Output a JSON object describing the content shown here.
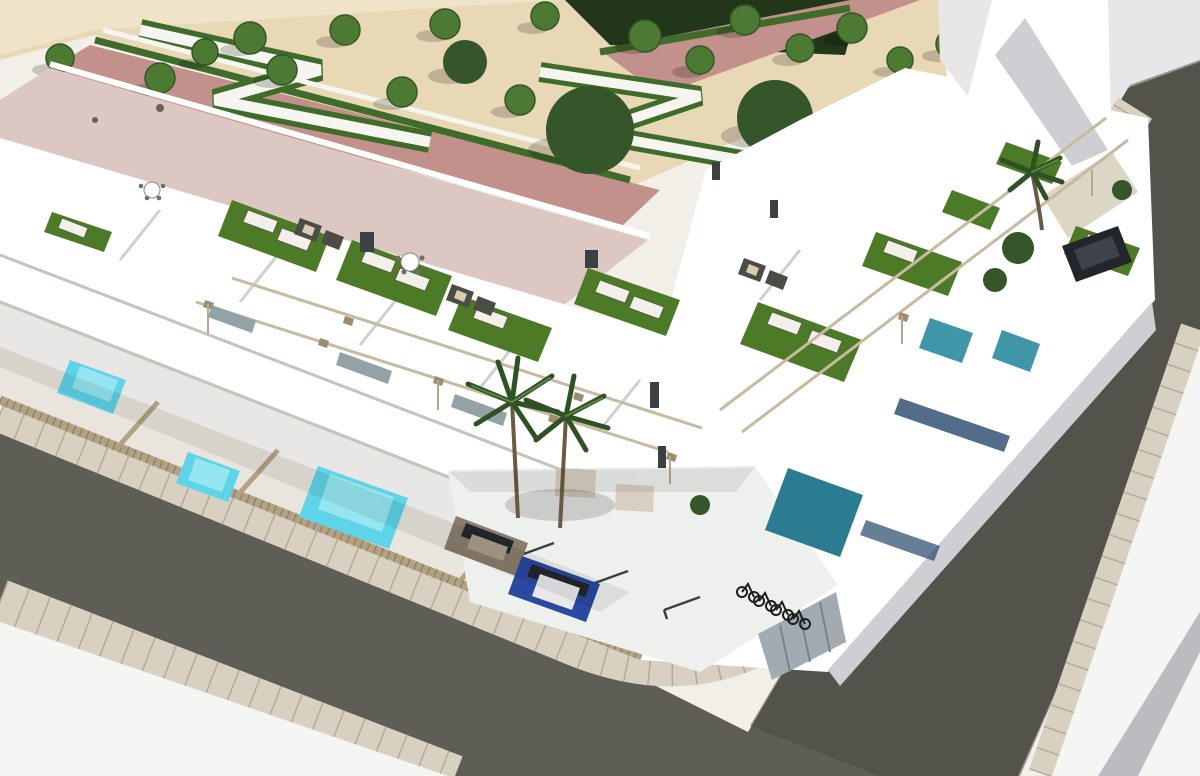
{
  "scene": {
    "type": "architectural-3d-render",
    "description": "Aerial 3D rendering of a modern white residential complex on a street corner: rows of townhouses with rooftop terraces (artificial grass, sun loungers, pergolas), private turquoise pools behind slatted fences, an interior parking court with cars and a bicycle shelter, palm trees, and a landscaped plaza with tree rows, zig-zag hedges and pink paved promenades.",
    "objects": {
      "park_trees": 22,
      "palm_trees": 3,
      "rooftop_terraces": 10,
      "sun_loungers": 12,
      "swimming_pools": 6,
      "cars": 3,
      "bicycles": 4,
      "streets": 2,
      "bicycle_shelter": 1,
      "pergola_rails": 4
    }
  },
  "palette": {
    "canvas_bg": "#f2efe9",
    "sky_gray": "#e7e7e9",
    "sand": "#e8d8b6",
    "sand_light": "#efe3c8",
    "pink_path": "#c2918b",
    "roof_pink": "#dcc7c2",
    "hedge_green": "#3f6b2b",
    "hedge_dark": "#22371a",
    "path_white": "#f7f5ef",
    "tree_green": "#4d7a33",
    "tree_dark": "#35552a",
    "shadow_black": "#000000",
    "white_wall": "#ffffff",
    "wall_shade": "#cfcfd3",
    "wall_shade_light": "#e8e7e5",
    "wall_shade_warm": "#d9d2c6",
    "yard_floor": "#e9e5dc",
    "court_floor": "#eef0ee",
    "terrace_grass": "#4c7a27",
    "lounger_white": "#f3f0e9",
    "lounger_edge": "#55524c",
    "sofa_dark": "#4d4b46",
    "cushion_beige": "#d8cdb2",
    "pergola_tan": "#c8ba9f",
    "post_tan": "#9c8d72",
    "fence_tan": "#b2a183",
    "fence_slat": "#8b7c62",
    "pool_turquoise": "#5fd3e8",
    "pool_light": "#b4f0f6",
    "pool_teal_mid": "#3f96a8",
    "pool_teal_dark": "#2b7c90",
    "pool_navy": "#27476b",
    "asphalt": "#5e5d56",
    "asphalt_dark": "#4a4944",
    "paver": "#d8d1c1",
    "paver_line": "#b4ab97",
    "lot_white": "#f5f5f4",
    "stripe_gray": "#8e8a96",
    "car_brown": "#8a7d6d",
    "car_brown_roof": "#ab9e8c",
    "car_blue": "#2a49a0",
    "car_roof_white": "#e9e9eb",
    "glass_dark": "#23262b",
    "car_dark": "#22252a",
    "car_dark_glass": "#3d434a",
    "bike_dark": "#1d1d1d",
    "shed_gray": "#a3abb2",
    "shed_line": "#7b828a",
    "window_dark": "#3b4042",
    "glass_teal": "#93a2a4",
    "beige_door": "#d8cfc0",
    "trunk_brown": "#6b5a42",
    "palm_green": "#2f5124",
    "palm_light": "#5e8444",
    "slab_line": "#c6c3bd",
    "table_edge": "#8a8a85",
    "chair_dot": "#6f6f6a"
  }
}
